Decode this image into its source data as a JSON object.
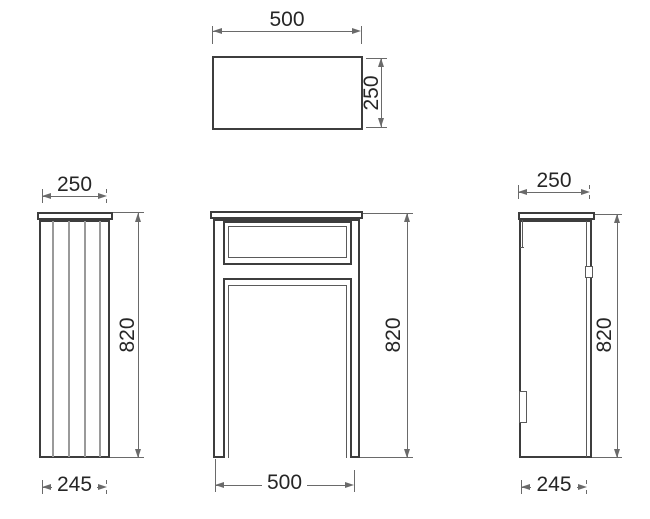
{
  "drawing": {
    "type": "technical-drawing",
    "subject": "cabinet orthographic projection views",
    "units_shown": "mm",
    "colors": {
      "background": "#ffffff",
      "object_line": "#3d3d3d",
      "groove_line": "#9a9a9a",
      "dimension_line": "#6a6a6a",
      "text": "#262626"
    },
    "views": {
      "top": {
        "name": "top view",
        "width": "500",
        "depth": "250"
      },
      "left": {
        "name": "left side view",
        "top_width": "250",
        "height": "820",
        "bottom_width": "245"
      },
      "front": {
        "name": "front view",
        "height": "820",
        "width": "500"
      },
      "right": {
        "name": "right side view",
        "top_width": "250",
        "height": "820",
        "bottom_width": "245"
      }
    }
  }
}
